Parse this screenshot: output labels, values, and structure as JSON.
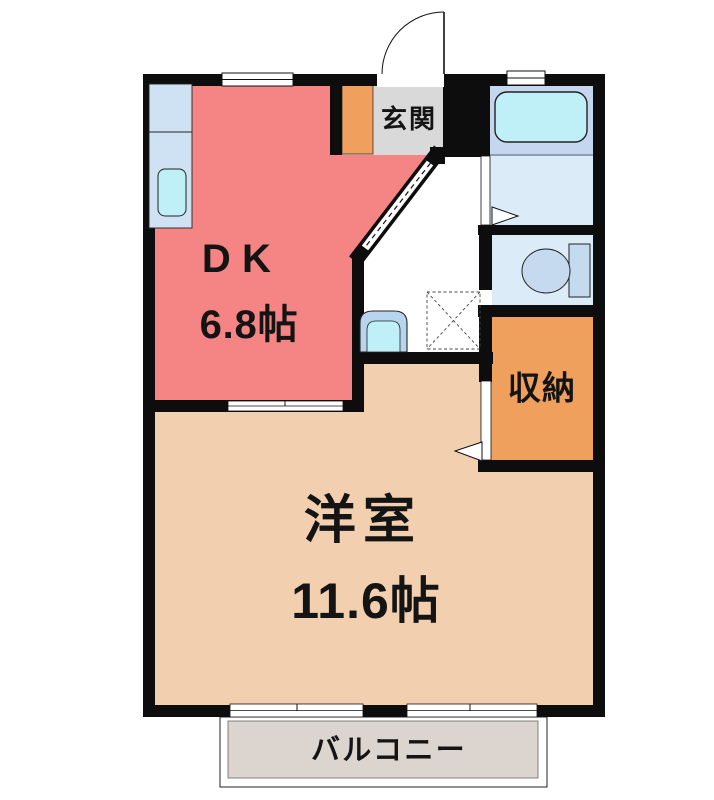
{
  "rooms": {
    "dk": {
      "label": "DK",
      "size": "6.8帖"
    },
    "western": {
      "label": "洋室",
      "size": "11.6帖"
    },
    "entrance": {
      "label": "玄関"
    },
    "storage": {
      "label": "収納"
    },
    "balcony": {
      "label": "バルコニー"
    }
  },
  "colors": {
    "wall": "#0d0d0d",
    "dk": "#f58484",
    "western": "#f2cfae",
    "storage": "#efa05c",
    "shoe_cabinet": "#efa05c",
    "entrance_floor": "#d9d9d9",
    "bath_upper": "#c4d7ee",
    "bath_lower": "#dcebf8",
    "toilet_room": "#dcebf8",
    "fixture_blue": "#c5d9ef",
    "water_cyan": "#bff0f8",
    "counter_blue": "#cfe2f4",
    "basin_blue": "#b7d5ef",
    "balcony_floor": "#dcd4ce"
  }
}
